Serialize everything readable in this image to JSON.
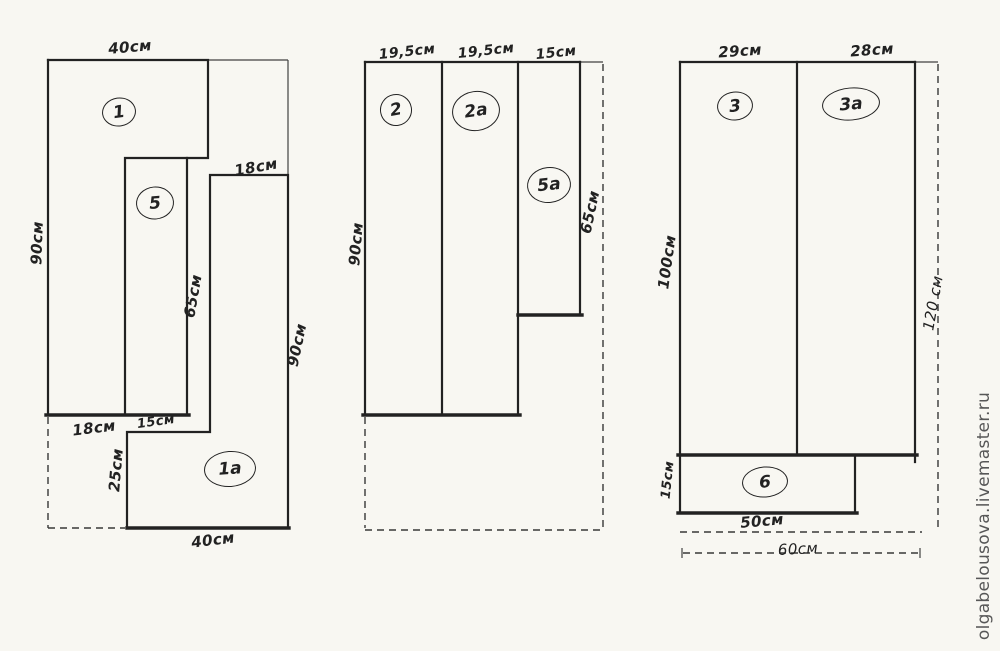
{
  "colors": {
    "paper": "#f8f7f2",
    "ink": "#222222",
    "watermark": "#575757"
  },
  "watermark_text": "olgabelousova.livemaster.ru",
  "panel1": {
    "piece_1_label": "1",
    "piece_5_label": "5",
    "piece_1a_label": "1a",
    "dim_top": "40см",
    "dim_left_height": "90см",
    "dim_piece1a_top": "18см",
    "dim_piece5_height": "65см",
    "dim_piece1a_height": "90см",
    "dim_bottom_left": "18см",
    "dim_bottom_mid": "15см",
    "dim_step_height": "25см",
    "dim_bottom_width": "40см"
  },
  "panel2": {
    "piece_2_label": "2",
    "piece_2a_label": "2a",
    "piece_5a_label": "5a",
    "dim_top_piece2": "19,5см",
    "dim_top_piece2a": "19,5см",
    "dim_top_piece5a": "15см",
    "dim_left_height": "90см",
    "dim_piece5a_height": "65см"
  },
  "panel3": {
    "piece_3_label": "3",
    "piece_3a_label": "3a",
    "piece_6_label": "6",
    "dim_top_piece3": "29см",
    "dim_top_piece3a": "28см",
    "dim_left_height": "100см",
    "dim_right_height": "120 см",
    "dim_piece6_height": "15см",
    "dim_piece6_width": "50см",
    "dim_overall_width": "60см"
  }
}
